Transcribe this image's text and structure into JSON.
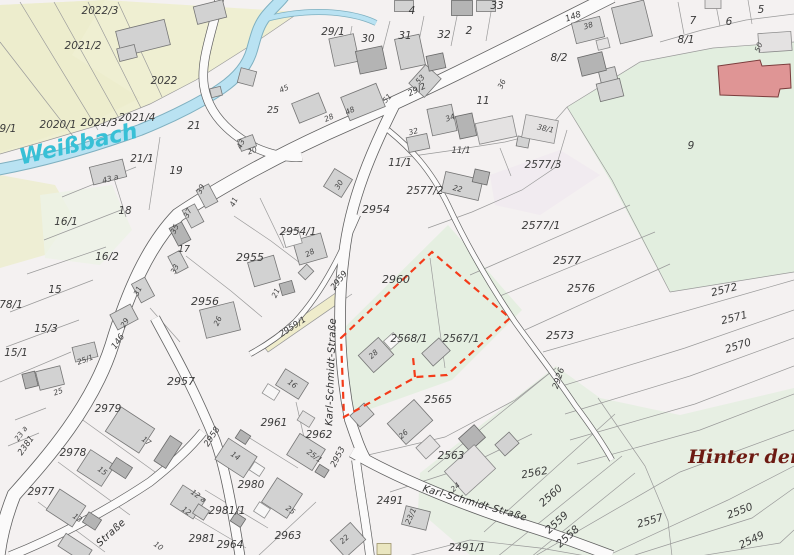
{
  "map": {
    "type": "cadastral-parcel-map",
    "water_name": "Weißbach",
    "street_name": "Karl-Schmidt-Straße",
    "place_name": "Hinter der",
    "selected_parcels": [
      "2568/1",
      "2567/1"
    ],
    "colors": {
      "selection_outline": "#f43b19",
      "water_fill": "#b9e2f2",
      "water_label": "#38c0d6",
      "place_label": "#6d1a12",
      "farmland_tint": "#efefd2",
      "meadow_tint": "#e7efe2",
      "public_building": "#df9595",
      "building_fill": "#d2d2d2",
      "road_fill": "#fbfafa"
    },
    "labels": [
      {
        "t": "2022/3",
        "x": 100,
        "y": 14
      },
      {
        "t": "2021/2",
        "x": 83,
        "y": 49
      },
      {
        "t": "2022",
        "x": 164,
        "y": 84
      },
      {
        "t": "2020/1",
        "x": 58,
        "y": 128
      },
      {
        "t": "2021/3",
        "x": 99,
        "y": 126
      },
      {
        "t": "2021/4",
        "x": 137,
        "y": 121
      },
      {
        "t": "9/1",
        "x": 8,
        "y": 132
      },
      {
        "t": "21",
        "x": 194,
        "y": 129
      },
      {
        "t": "21/1",
        "x": 142,
        "y": 162
      },
      {
        "t": "19",
        "x": 176,
        "y": 174
      },
      {
        "t": "18",
        "x": 125,
        "y": 214
      },
      {
        "t": "16/1",
        "x": 66,
        "y": 225
      },
      {
        "t": "16/2",
        "x": 107,
        "y": 260
      },
      {
        "t": "15",
        "x": 55,
        "y": 293
      },
      {
        "t": "15/3",
        "x": 46,
        "y": 332
      },
      {
        "t": "15/1",
        "x": 16,
        "y": 356
      },
      {
        "t": "78/1",
        "x": 11,
        "y": 308
      },
      {
        "t": "29/1",
        "x": 333,
        "y": 35
      },
      {
        "t": "30",
        "x": 368,
        "y": 42
      },
      {
        "t": "31",
        "x": 405,
        "y": 39
      },
      {
        "t": "32",
        "x": 444,
        "y": 38
      },
      {
        "t": "33",
        "x": 497,
        "y": 9
      },
      {
        "t": "4",
        "x": 412,
        "y": 14
      },
      {
        "t": "2",
        "x": 469,
        "y": 34
      },
      {
        "t": "5",
        "x": 761,
        "y": 13
      },
      {
        "t": "7",
        "x": 693,
        "y": 24
      },
      {
        "t": "6",
        "x": 729,
        "y": 25
      },
      {
        "t": "8/1",
        "x": 686,
        "y": 43
      },
      {
        "t": "8/2",
        "x": 559,
        "y": 61
      },
      {
        "t": "9",
        "x": 691,
        "y": 149
      },
      {
        "t": "11",
        "x": 483,
        "y": 104
      },
      {
        "t": "11/1",
        "x": 400,
        "y": 166
      },
      {
        "t": "11/1",
        "x": 461,
        "y": 153,
        "s": 8.5
      },
      {
        "t": "2577/3",
        "x": 543,
        "y": 168
      },
      {
        "t": "2577/2",
        "x": 425,
        "y": 194
      },
      {
        "t": "2577/1",
        "x": 541,
        "y": 229,
        "s": 11
      },
      {
        "t": "2577",
        "x": 567,
        "y": 264,
        "s": 11
      },
      {
        "t": "2576",
        "x": 581,
        "y": 292,
        "s": 11
      },
      {
        "t": "2573",
        "x": 560,
        "y": 339,
        "s": 11
      },
      {
        "t": "2572",
        "x": 725,
        "y": 293,
        "r": -14
      },
      {
        "t": "2571",
        "x": 735,
        "y": 321,
        "r": -14
      },
      {
        "t": "2570",
        "x": 739,
        "y": 349,
        "r": -17
      },
      {
        "t": "2954",
        "x": 376,
        "y": 213,
        "s": 11
      },
      {
        "t": "2954/1",
        "x": 298,
        "y": 235
      },
      {
        "t": "2955",
        "x": 250,
        "y": 261,
        "s": 11
      },
      {
        "t": "2956",
        "x": 205,
        "y": 305,
        "s": 11
      },
      {
        "t": "2957",
        "x": 181,
        "y": 385,
        "s": 11
      },
      {
        "t": "2960",
        "x": 396,
        "y": 283,
        "s": 11
      },
      {
        "t": "2568/1",
        "x": 409,
        "y": 342
      },
      {
        "t": "2567/1",
        "x": 461,
        "y": 342
      },
      {
        "t": "2565",
        "x": 438,
        "y": 403,
        "s": 11
      },
      {
        "t": "2563",
        "x": 451,
        "y": 459
      },
      {
        "t": "2562",
        "x": 535,
        "y": 476,
        "r": -10
      },
      {
        "t": "2560",
        "x": 553,
        "y": 498,
        "r": -42
      },
      {
        "t": "2559",
        "x": 559,
        "y": 525,
        "r": -42
      },
      {
        "t": "2558",
        "x": 570,
        "y": 539,
        "r": -42
      },
      {
        "t": "2557",
        "x": 651,
        "y": 524,
        "r": -16
      },
      {
        "t": "2550",
        "x": 741,
        "y": 514,
        "r": -21
      },
      {
        "t": "2549",
        "x": 753,
        "y": 543,
        "r": -26
      },
      {
        "t": "2979",
        "x": 108,
        "y": 412
      },
      {
        "t": "2978",
        "x": 73,
        "y": 456
      },
      {
        "t": "2977",
        "x": 41,
        "y": 495
      },
      {
        "t": "2961",
        "x": 274,
        "y": 426
      },
      {
        "t": "2962",
        "x": 319,
        "y": 438
      },
      {
        "t": "2980",
        "x": 251,
        "y": 488
      },
      {
        "t": "2981/1",
        "x": 227,
        "y": 514
      },
      {
        "t": "2981",
        "x": 202,
        "y": 542
      },
      {
        "t": "2964",
        "x": 230,
        "y": 548
      },
      {
        "t": "2963",
        "x": 288,
        "y": 539
      },
      {
        "t": "2491",
        "x": 390,
        "y": 504
      },
      {
        "t": "2491/1",
        "x": 467,
        "y": 551
      },
      {
        "t": "25",
        "x": 273,
        "y": 113,
        "s": 9.5
      },
      {
        "t": "17",
        "x": 184,
        "y": 252,
        "s": 9.5
      },
      {
        "t": "148",
        "x": 574,
        "y": 19,
        "r": -20,
        "c": "road"
      },
      {
        "t": "146",
        "x": 120,
        "y": 343,
        "r": -55,
        "c": "road"
      },
      {
        "t": "29/2",
        "x": 418,
        "y": 92,
        "r": -27,
        "c": "road"
      },
      {
        "t": "2959",
        "x": 341,
        "y": 282,
        "r": -52,
        "c": "road"
      },
      {
        "t": "2959/1",
        "x": 294,
        "y": 329,
        "r": -33,
        "c": "road"
      },
      {
        "t": "2958",
        "x": 214,
        "y": 438,
        "r": -57,
        "c": "road"
      },
      {
        "t": "2953",
        "x": 340,
        "y": 458,
        "r": -63,
        "c": "road"
      },
      {
        "t": "2926",
        "x": 561,
        "y": 379,
        "r": -72,
        "c": "road"
      },
      {
        "t": "2381",
        "x": 28,
        "y": 447,
        "r": -55,
        "c": "road"
      },
      {
        "t": "Karl-Schmidt-Straße",
        "x": 334,
        "y": 372,
        "r": -88,
        "c": "street"
      },
      {
        "t": "Karl-Schmidt-Straße",
        "x": 474,
        "y": 506,
        "r": 16,
        "c": "street"
      },
      {
        "t": "Straße",
        "x": 113,
        "y": 535,
        "r": -42,
        "c": "street"
      },
      {
        "t": "Weißbach",
        "x": 80,
        "y": 151,
        "r": -13,
        "c": "water"
      },
      {
        "t": "Hinter der",
        "x": 744,
        "y": 463,
        "c": "place"
      },
      {
        "t": "45",
        "x": 285,
        "y": 91,
        "r": -25,
        "c": "house"
      },
      {
        "t": "28",
        "x": 330,
        "y": 120,
        "r": -25,
        "c": "house"
      },
      {
        "t": "48",
        "x": 351,
        "y": 113,
        "r": -25,
        "c": "house"
      },
      {
        "t": "51",
        "x": 389,
        "y": 100,
        "r": -48,
        "c": "house"
      },
      {
        "t": "53",
        "x": 422,
        "y": 81,
        "r": -48,
        "c": "house"
      },
      {
        "t": "34",
        "x": 451,
        "y": 120,
        "r": -20,
        "c": "house"
      },
      {
        "t": "36",
        "x": 504,
        "y": 85,
        "r": -65,
        "c": "house"
      },
      {
        "t": "38",
        "x": 589,
        "y": 28,
        "r": -18,
        "c": "house"
      },
      {
        "t": "43",
        "x": 243,
        "y": 145,
        "r": -65,
        "c": "house"
      },
      {
        "t": "20",
        "x": 253,
        "y": 153,
        "r": -20,
        "c": "house"
      },
      {
        "t": "41",
        "x": 236,
        "y": 203,
        "r": -65,
        "c": "house"
      },
      {
        "t": "39",
        "x": 203,
        "y": 190,
        "r": -65,
        "c": "house"
      },
      {
        "t": "37",
        "x": 190,
        "y": 214,
        "r": -65,
        "c": "house"
      },
      {
        "t": "35",
        "x": 177,
        "y": 230,
        "r": -65,
        "c": "house"
      },
      {
        "t": "33",
        "x": 177,
        "y": 270,
        "r": -65,
        "c": "house"
      },
      {
        "t": "31",
        "x": 140,
        "y": 292,
        "r": -65,
        "c": "house"
      },
      {
        "t": "29",
        "x": 127,
        "y": 324,
        "r": -60,
        "c": "house"
      },
      {
        "t": "25/1",
        "x": 86,
        "y": 362,
        "r": -20,
        "c": "house"
      },
      {
        "t": "25",
        "x": 59,
        "y": 394,
        "r": -20,
        "c": "house"
      },
      {
        "t": "26",
        "x": 220,
        "y": 322,
        "r": -65,
        "c": "house"
      },
      {
        "t": "21",
        "x": 278,
        "y": 294,
        "r": -65,
        "c": "house"
      },
      {
        "t": "28",
        "x": 311,
        "y": 255,
        "r": -28,
        "c": "house"
      },
      {
        "t": "30",
        "x": 341,
        "y": 186,
        "r": -58,
        "c": "house"
      },
      {
        "t": "22",
        "x": 457,
        "y": 191,
        "r": 14,
        "c": "house"
      },
      {
        "t": "32",
        "x": 414,
        "y": 134,
        "r": -15,
        "c": "house"
      },
      {
        "t": "38/1",
        "x": 545,
        "y": 131,
        "r": 12,
        "c": "house"
      },
      {
        "t": "43 a",
        "x": 111,
        "y": 181,
        "r": -15,
        "c": "house"
      },
      {
        "t": "23 a",
        "x": 23,
        "y": 435,
        "r": -55,
        "c": "house"
      },
      {
        "t": "50",
        "x": 761,
        "y": 48,
        "r": -70,
        "c": "house"
      },
      {
        "t": "17",
        "x": 145,
        "y": 443,
        "r": 35,
        "c": "house"
      },
      {
        "t": "15",
        "x": 101,
        "y": 473,
        "r": 35,
        "c": "house"
      },
      {
        "t": "13",
        "x": 76,
        "y": 520,
        "r": 35,
        "c": "house"
      },
      {
        "t": "12 a",
        "x": 197,
        "y": 498,
        "r": 35,
        "c": "house"
      },
      {
        "t": "12",
        "x": 185,
        "y": 513,
        "r": 35,
        "c": "house"
      },
      {
        "t": "10",
        "x": 157,
        "y": 548,
        "r": 35,
        "c": "house"
      },
      {
        "t": "14",
        "x": 234,
        "y": 458,
        "r": 35,
        "c": "house"
      },
      {
        "t": "25",
        "x": 289,
        "y": 512,
        "r": 35,
        "c": "house"
      },
      {
        "t": "16",
        "x": 291,
        "y": 386,
        "r": 35,
        "c": "house"
      },
      {
        "t": "25/1",
        "x": 313,
        "y": 458,
        "r": 35,
        "c": "house"
      },
      {
        "t": "28",
        "x": 375,
        "y": 356,
        "r": -42,
        "c": "house"
      },
      {
        "t": "26",
        "x": 405,
        "y": 436,
        "r": -42,
        "c": "house"
      },
      {
        "t": "24",
        "x": 457,
        "y": 489,
        "r": -42,
        "c": "house"
      },
      {
        "t": "22",
        "x": 346,
        "y": 541,
        "r": -42,
        "c": "house"
      },
      {
        "t": "23/1",
        "x": 413,
        "y": 517,
        "r": -66,
        "c": "house"
      }
    ]
  }
}
